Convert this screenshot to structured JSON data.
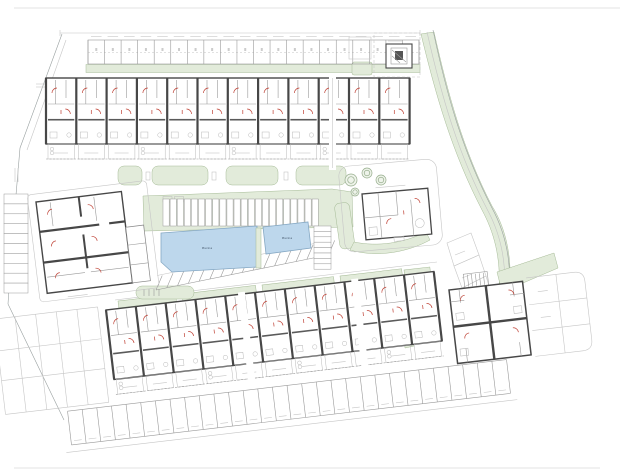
{
  "title": "Residential complex site plan drawing",
  "colors": {
    "paper": "#ffffff",
    "green": "#e2ebda",
    "greenb": "#a6bb97",
    "pool": "#bdd7ec",
    "poolb": "#85a8c4",
    "wall": "#474747",
    "red": "#bf4135"
  },
  "pools": {
    "large_label": "Piscina",
    "small_label": "Piscina"
  },
  "counts": {
    "top_parking_stalls": 20,
    "island_parking_stalls": 22,
    "diagonal_parking_stalls": 16,
    "side_parking_stalls": 8,
    "west_parking_stalls": 10,
    "south_parking_stalls": 30,
    "north_row_units": 12,
    "south_row_units": 11,
    "hedge_blocks": 4,
    "curve_plots": 3,
    "trees": 4
  }
}
